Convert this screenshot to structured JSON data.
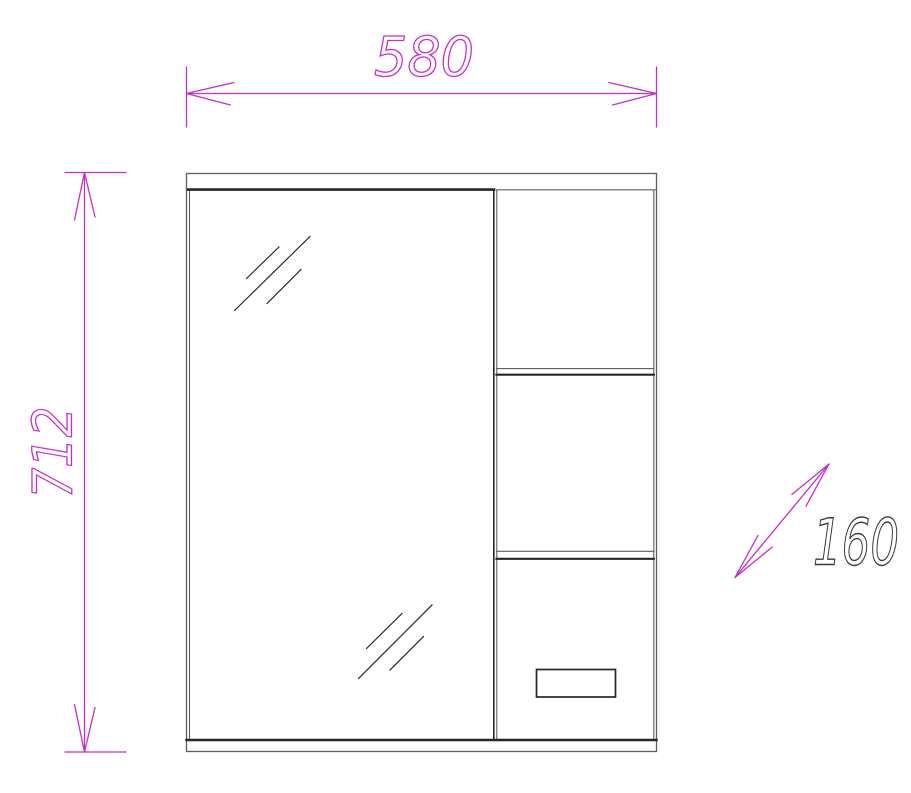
{
  "drawing": {
    "subject": "mirror-cabinet-front-view",
    "dimensions": {
      "width": "580",
      "height": "712",
      "depth": "160"
    },
    "colors": {
      "dimension_accent": "#c52fc5",
      "depth_label": "#3a3a3a",
      "outline_dark": "#262626",
      "outline_light": "#5f5f5f",
      "background": "#ffffff"
    }
  }
}
